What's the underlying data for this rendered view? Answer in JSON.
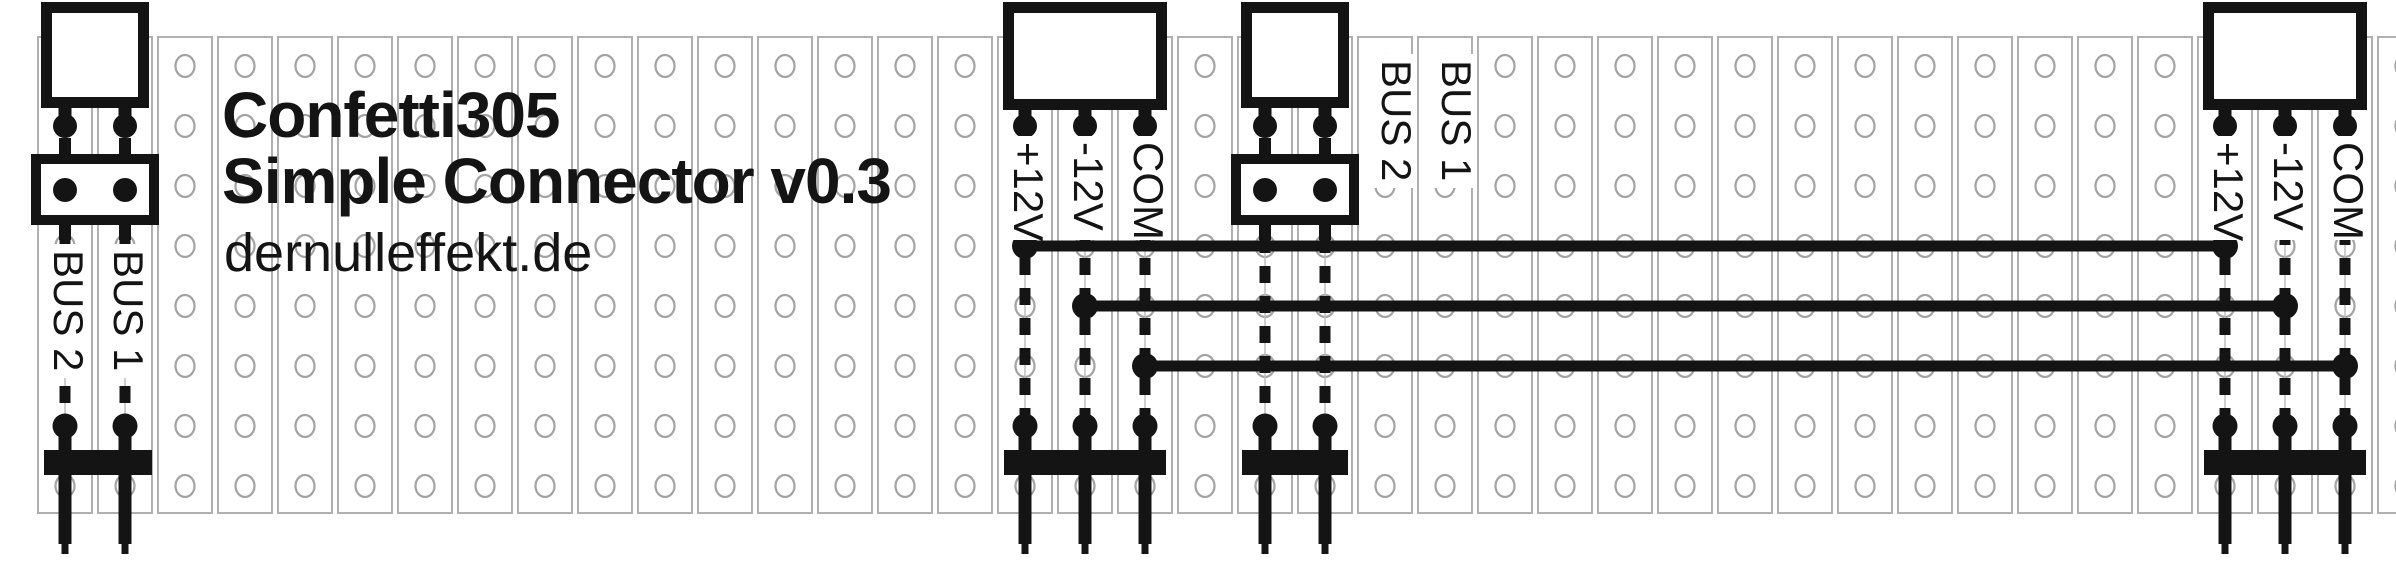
{
  "title": {
    "product": "Confetti305",
    "subtitle": "Simple Connector v0.3",
    "website": "dernulleffekt.de"
  },
  "modules": {
    "bus_connector_left": {
      "name": "2-pin bus connector (left)",
      "labels": {
        "bus1": "BUS 1",
        "bus2": "BUS 2"
      }
    },
    "power_connector_in": {
      "name": "3-pin power connector (middle)",
      "labels": {
        "plus12": "+12V",
        "minus12": "-12V",
        "com": "COM"
      }
    },
    "bus_connector_mid": {
      "name": "2-pin bus connector (middle)",
      "labels": {
        "bus1": "BUS 1",
        "bus2": "BUS 2"
      }
    },
    "power_connector_out": {
      "name": "3-pin power connector (right)",
      "labels": {
        "plus12": "+12V",
        "minus12": "-12V",
        "com": "COM"
      }
    }
  },
  "colors": {
    "ink": "#141414",
    "strip_outline": "#b0b0b0",
    "hole_outline": "#a3a3a3",
    "background": "#ffffff"
  }
}
